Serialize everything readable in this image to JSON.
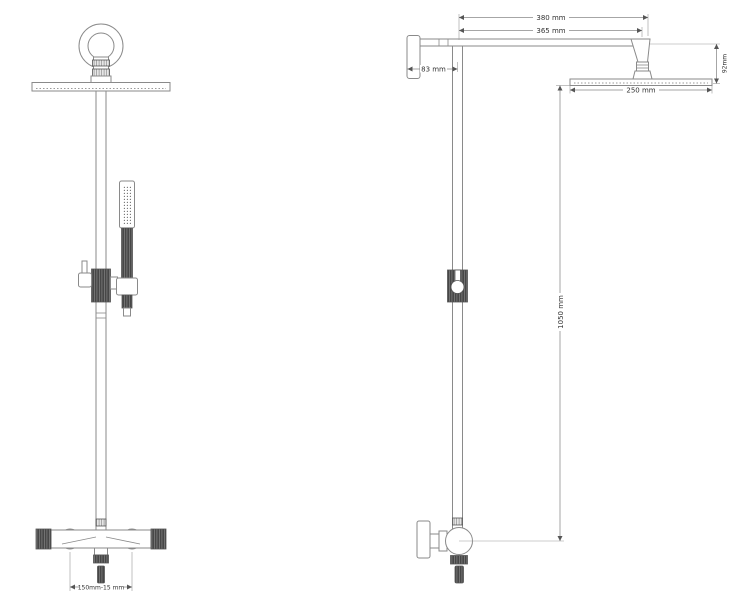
{
  "drawing": {
    "colors": {
      "background": "#ffffff",
      "line": "#8a8a8a",
      "dark_fill": "#474747",
      "dimension_text": "#333333"
    },
    "front_view": {
      "dimensions": {
        "inlet_spacing": "150mm-15 mm"
      }
    },
    "side_view": {
      "dimensions": {
        "arm_overall": "380 mm",
        "arm_to_head": "365 mm",
        "wall_offset": "83 mm",
        "head_drop": "92mm",
        "head_width": "250 mm",
        "riser_height": "1050 mm"
      }
    }
  }
}
